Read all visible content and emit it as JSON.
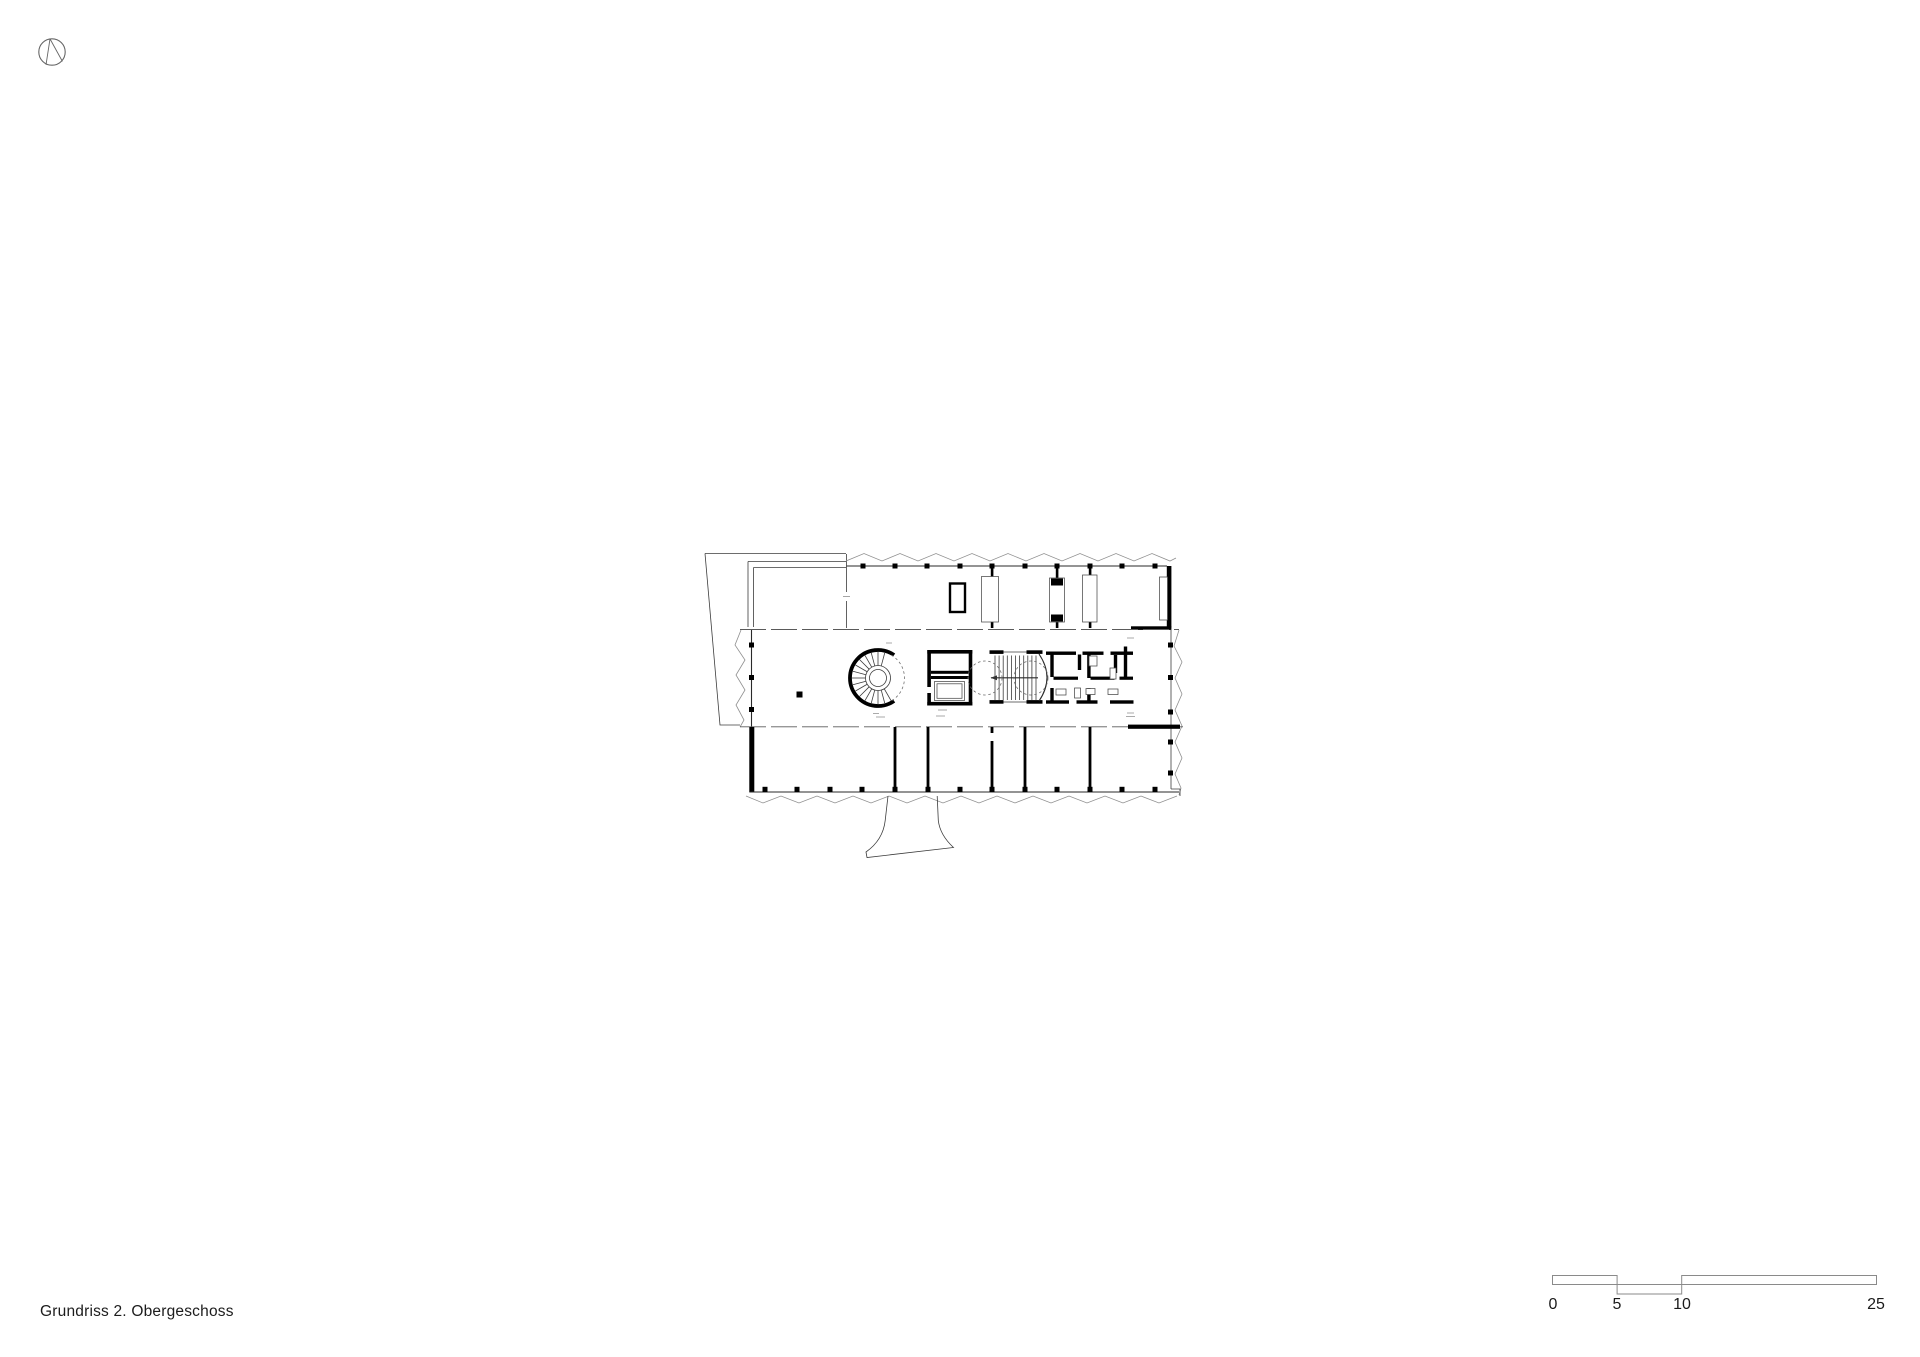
{
  "colors": {
    "background": "#ffffff",
    "ink": "#000000",
    "line": "#3c3c3c",
    "light_line": "#8f8f8f",
    "text": "#1c1c1c"
  },
  "north_indicator": {
    "icon": "north-arrow-icon"
  },
  "plan": {
    "name": "floor-plan-drawing"
  },
  "caption": {
    "text": "Grundriss 2. Obergeschoss"
  },
  "scale_bar": {
    "labels": [
      "0",
      "5",
      "10",
      "25"
    ]
  }
}
